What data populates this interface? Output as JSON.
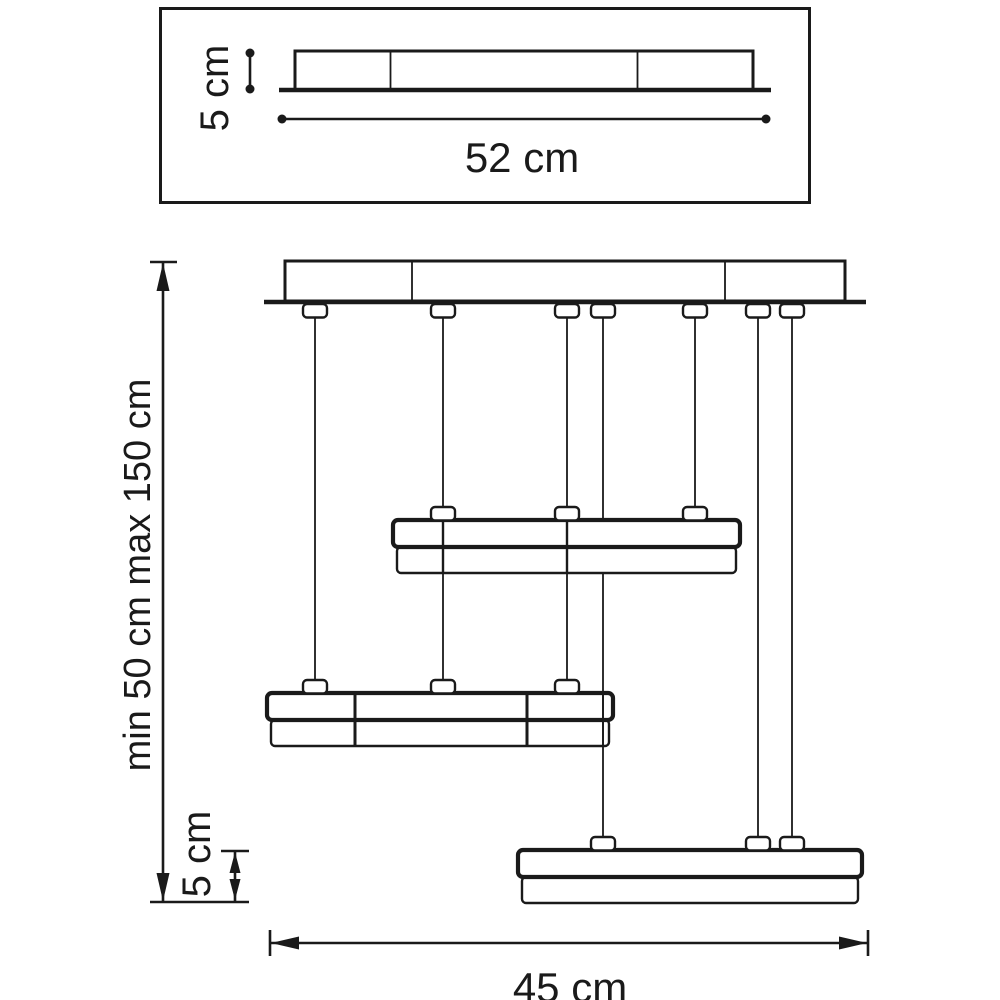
{
  "colors": {
    "line": "#1a1a1a",
    "background": "#ffffff"
  },
  "top_view": {
    "height_label": "5 cm",
    "width_label": "52 cm"
  },
  "side_view": {
    "drop_range_label": "min 50 cm max 150 cm",
    "shade_height_label": "5 cm",
    "fixture_width_label": "45 cm"
  }
}
